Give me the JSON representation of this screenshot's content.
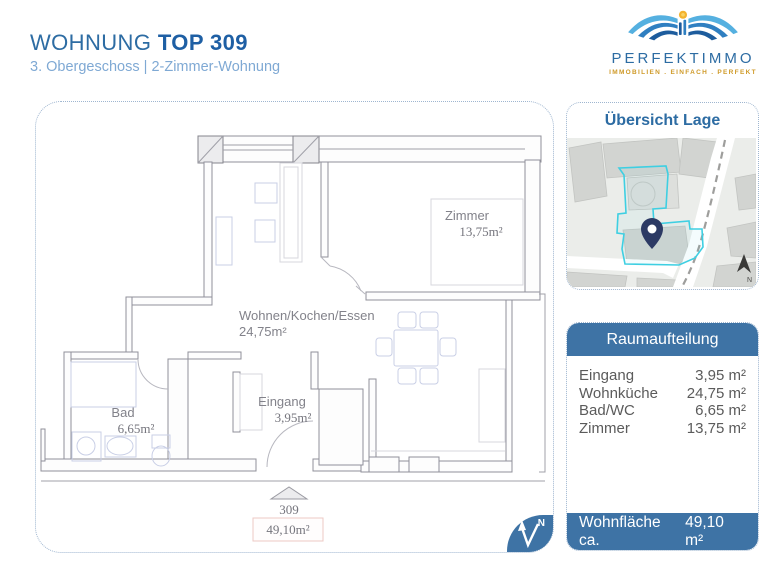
{
  "header": {
    "title_prefix": "WOHNUNG",
    "title_bold": "TOP 309",
    "subtitle": "3. Obergeschoss | 2-Zimmer-Wohnung"
  },
  "logo": {
    "name": "PERFEKTIMMO",
    "tagline": "IMMOBILIEN . EINFACH . PERFEKT"
  },
  "floorplan": {
    "zimmer": {
      "name": "Zimmer",
      "area": "13,75m²"
    },
    "wohnen": {
      "name": "Wohnen/Kochen/Essen",
      "area": "24,75m²"
    },
    "bad": {
      "name": "Bad",
      "area": "6,65m²"
    },
    "eingang": {
      "name": "Eingang",
      "area": "3,95m²"
    },
    "unit_number": "309",
    "total_area": "49,10m²",
    "north_label": "N"
  },
  "map_panel": {
    "title": "Übersicht Lage",
    "north_label": "N"
  },
  "room_table": {
    "title": "Raumaufteilung",
    "rows": [
      {
        "label": "Eingang",
        "value": "3,95 m²"
      },
      {
        "label": "Wohnküche",
        "value": "24,75 m²"
      },
      {
        "label": "Bad/WC",
        "value": "6,65 m²"
      },
      {
        "label": "Zimmer",
        "value": "13,75 m²"
      }
    ],
    "footer_label": "Wohnfläche ca.",
    "footer_value": "49,10 m²"
  },
  "colors": {
    "brand_blue": "#2d6ca3",
    "panel_blue": "#3e73a5",
    "subtitle_blue": "#7fa9d4",
    "logo_gold": "#cf9a28",
    "parcel_cyan": "#3ecfe2",
    "pin_navy": "#2c3a64"
  }
}
